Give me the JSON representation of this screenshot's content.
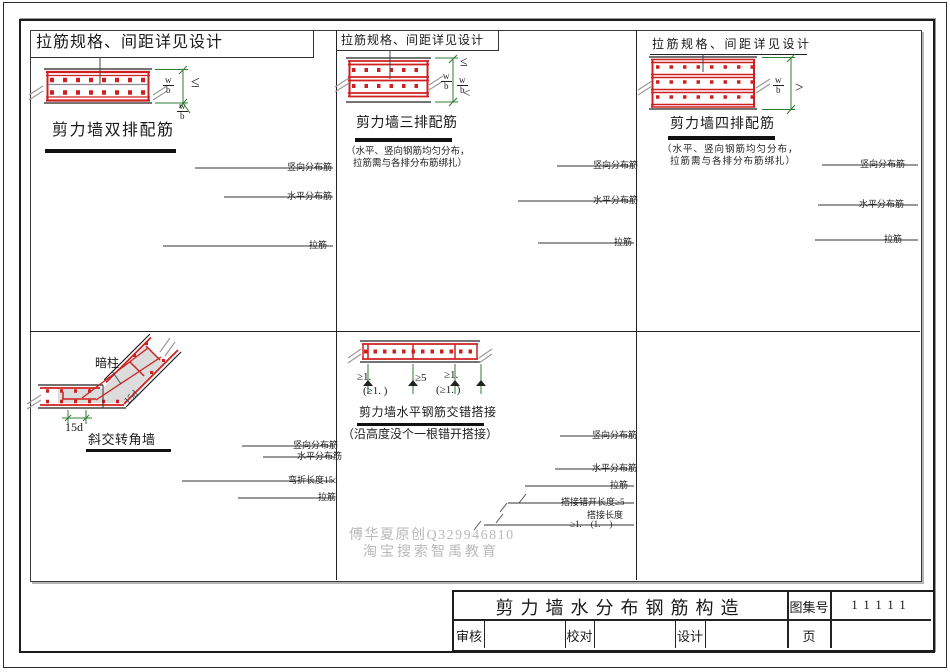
{
  "dims": {
    "num": "w",
    "den": "b",
    "le": "≤",
    "lt": "<",
    "gt": ">"
  },
  "p1": {
    "heading": "拉筋规格、间距详见设计",
    "title": "剪力墙双排配筋",
    "labels": [
      "竖向分布筋",
      "水平分布筋",
      "拉筋"
    ]
  },
  "p2": {
    "heading": "拉筋规格、间距详见设计",
    "title": "剪力墙三排配筋",
    "note1": "（水平、竖向钢筋均匀分布，",
    "note2": "拉筋需与各排分布筋绑扎）",
    "labels": [
      "竖向分布筋",
      "水平分布筋",
      "拉筋"
    ]
  },
  "p3": {
    "heading": "拉筋规格、间距详见设计",
    "title": "剪力墙四排配筋",
    "note1": "（水平、竖向钢筋均匀分布，",
    "note2": "拉筋需与各排分布筋绑扎）",
    "labels": [
      "竖向分布筋",
      "水平分布筋",
      "拉筋"
    ]
  },
  "p4": {
    "title": "斜交转角墙",
    "column_label": "暗柱",
    "dim_15d": "15d",
    "diag_15d": "15d",
    "labels": [
      "竖向分布筋",
      "水平分布筋",
      "弯折长度15d",
      "拉筋"
    ]
  },
  "p5": {
    "title": "剪力墙水平钢筋交错搭接",
    "note": "（沿高度没个一根错开搭接）",
    "dims": {
      "d1": "≥1.",
      "d1p": "(≥1. )",
      "d2": "≥5",
      "d3": "≥1.",
      "d3p": "(≥1. )"
    },
    "labels": [
      "竖向分布筋",
      "水平分布筋",
      "拉筋",
      "搭接错开长度≥5",
      "搭接长度",
      "≥1.　(1.　)"
    ]
  },
  "watermark": {
    "line1": "傅华夏原创Q329946810",
    "line2": "淘宝搜索智禹教育"
  },
  "titleblock": {
    "title": "剪力墙水分布钢筋构造",
    "atlas_label": "图集号",
    "atlas_no": "11111",
    "review": "审核",
    "proof": "校对",
    "design": "设计",
    "page": "页"
  }
}
